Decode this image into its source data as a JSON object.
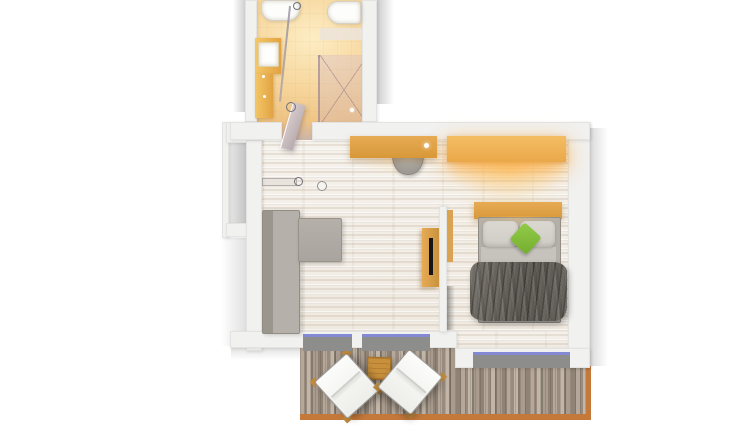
{
  "meta": {
    "kind": "floor-plan-rendering",
    "view": "top-down-3d",
    "text_visible": false
  },
  "colors": {
    "canvas_bg": "#ffffff",
    "wall": "#f1f1f0",
    "wall_line": "#e3e3e1",
    "outside_shadow": "#cfcfcf",
    "bath_floor_light": "#fdedc4",
    "bath_floor_deep": "#e7b265",
    "shower_tint": "#d6bcc9",
    "shower_line": "#8e7485",
    "fixture_white": "#fdfdfb",
    "vanity_wood_a": "#f3c768",
    "vanity_wood_b": "#e2a342",
    "wood_a": "#e7ab54",
    "wood_b": "#d79838",
    "wood_lit_a": "#f4bd63",
    "wood_lit_b": "#eaa84a",
    "glow": "#ffc870",
    "floor_light": "#f6f2ec",
    "floor_dark": "#efe9e0",
    "sofa": "#a9a49e",
    "sofa_dark": "#9a958d",
    "sofa_light": "#b5b0a9",
    "bed_frame_line": "#8f8b85",
    "mattress": "#b3afa9",
    "sheet": "#c6c2bc",
    "pillow": "#dbd8d2",
    "green_a": "#93cc4a",
    "green_b": "#74ae2c",
    "duvet_a": "#716d66",
    "duvet_b": "#5b5751",
    "tv_black": "#151515",
    "window_gray": "#8d8d8b",
    "glass_blue": "#8489d6",
    "deck_a": "#b5a89a",
    "deck_b": "#998c7f",
    "deck_c": "#c2b6a8",
    "deck_d": "#857a6e",
    "deck_e": "#a99c8e",
    "deck_border": "#c4793b",
    "lounger_white": "#fcfcfa",
    "lounger_frame": "#9b9b99",
    "lounger_foot": "#c08a3f",
    "table_wood": "#c8903c",
    "door_leaf_a": "#d8ccce",
    "door_leaf_b": "#b7aaae",
    "ring": "#6f6f78"
  },
  "rooms": {
    "bathroom": {
      "elements": [
        "washbasin",
        "toilet",
        "vanity-counter",
        "counter-basin",
        "shower-area",
        "glass-screen",
        "swing-door"
      ]
    },
    "living_area": {
      "elements": [
        "corner-sofa",
        "desk",
        "desk-chair",
        "tv-board",
        "tv",
        "entry-door",
        "decor-bowl",
        "balcony-window-doors"
      ]
    },
    "sleeping_area": {
      "elements": [
        "double-bed",
        "headboard-shelf",
        "pillows",
        "green-accent-pillow",
        "duvet",
        "illuminated-panel",
        "partition-wall",
        "bedroom-window"
      ]
    },
    "balcony": {
      "elements": [
        "wooden-deck",
        "sun-lounger-left",
        "sun-lounger-right",
        "side-table",
        "railing-edge"
      ]
    }
  }
}
